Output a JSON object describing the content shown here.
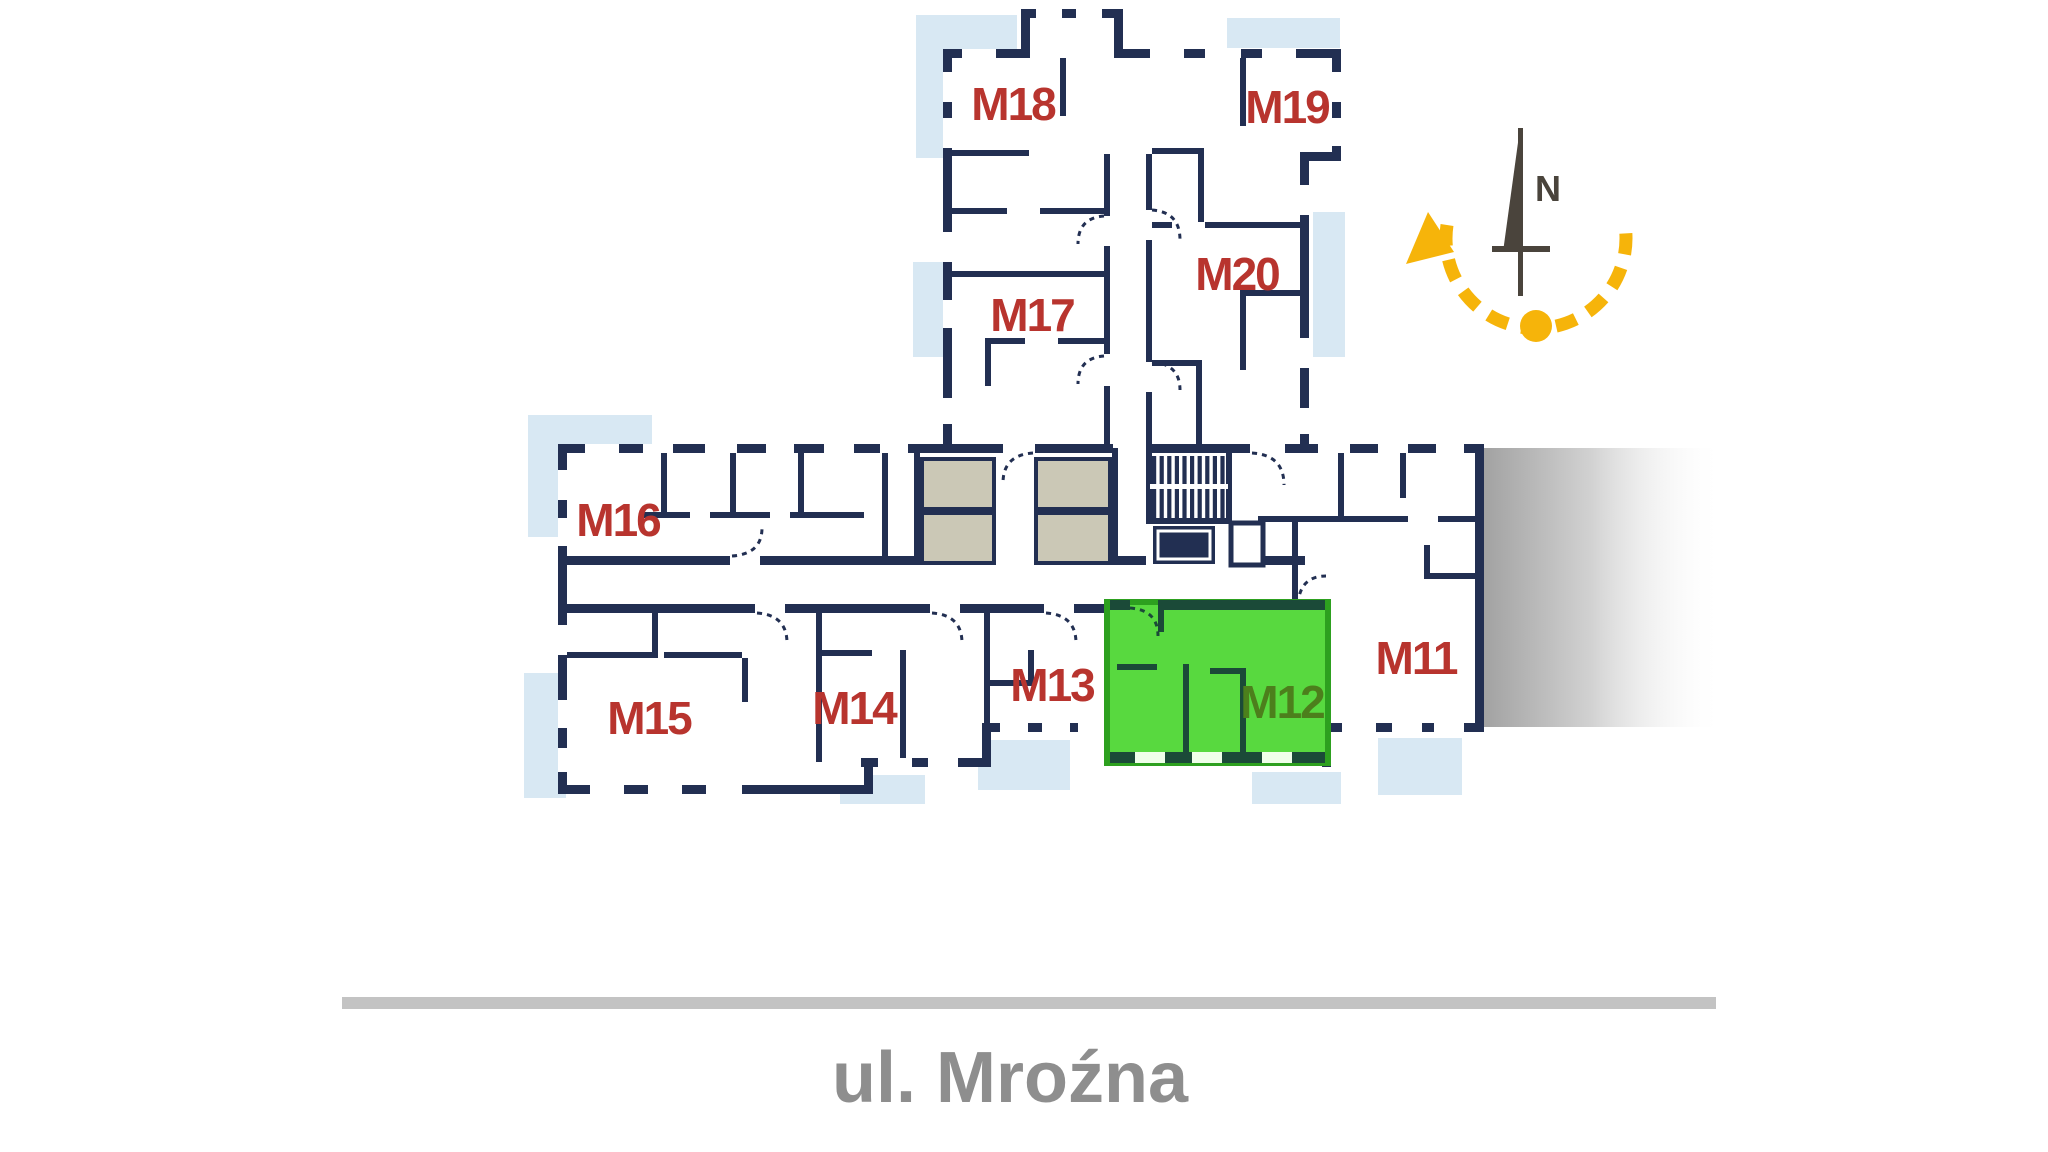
{
  "street": {
    "label": "ul. Mroźna"
  },
  "compass": {
    "north_label": "N"
  },
  "units": {
    "m11": {
      "label": "M11",
      "highlighted": false
    },
    "m12": {
      "label": "M12",
      "highlighted": true
    },
    "m13": {
      "label": "M13",
      "highlighted": false
    },
    "m14": {
      "label": "M14",
      "highlighted": false
    },
    "m15": {
      "label": "M15",
      "highlighted": false
    },
    "m16": {
      "label": "M16",
      "highlighted": false
    },
    "m17": {
      "label": "M17",
      "highlighted": false
    },
    "m18": {
      "label": "M18",
      "highlighted": false
    },
    "m19": {
      "label": "M19",
      "highlighted": false
    },
    "m20": {
      "label": "M20",
      "highlighted": false
    }
  },
  "colors": {
    "wall": "#222f52",
    "label": "#b8342e",
    "highlight-fill": "#58d93f",
    "highlight-stroke": "#2da01f",
    "highlight-label": "#4c7f1c",
    "highlight-wall": "#1b4a38",
    "balcony": "#d8e8f3",
    "beige": "#cbc8b6",
    "yellow": "#f6b40a",
    "needle": "#4a443c",
    "street-bar": "#c3c3c3",
    "street-text": "#8e8e8e"
  }
}
